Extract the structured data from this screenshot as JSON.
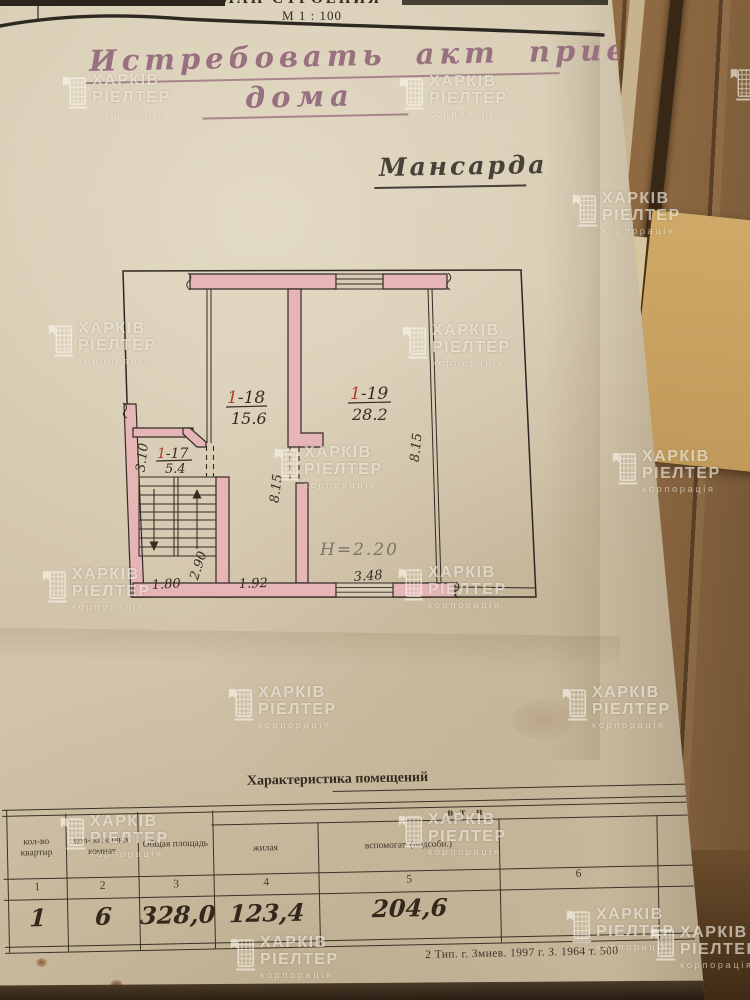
{
  "header": {
    "doc_title_partial": "ПЛАН СТРОЕНИЯ",
    "scale_label": "М 1 : 100"
  },
  "handwriting": {
    "line1": "Истребовать акт приемки",
    "line2": "дома",
    "floor_label": "Мансарда"
  },
  "plan": {
    "rooms": {
      "r17": {
        "red": "1",
        "rest": "-17",
        "area": "5.4"
      },
      "r18": {
        "red": "1",
        "rest": "-18",
        "area": "15.6"
      },
      "r19": {
        "red": "1",
        "rest": "-19",
        "area": "28.2"
      }
    },
    "height_note": "Н=2.20",
    "dims": {
      "left_height": "3.10",
      "stair_width": "1.80",
      "stair_depth": "2.90",
      "corridor_width": "1.92",
      "window_width": "3.48",
      "depth_left": "8.15",
      "depth_right": "8.15"
    },
    "colors": {
      "wall_fill": "#e6b6b6",
      "ink": "#332b24",
      "room_number_red": "#b23b2e"
    }
  },
  "table": {
    "title": "Характеристика помещений",
    "including_label": "в т. ч.",
    "columns": [
      {
        "num": "1",
        "header": "кол-во квартир",
        "value": "1"
      },
      {
        "num": "2",
        "header": "кол-во жилых комнат",
        "value": "6"
      },
      {
        "num": "3",
        "header": "Общая площадь",
        "value": "328,0"
      },
      {
        "num": "4",
        "header": "жилая",
        "value": "123,4"
      },
      {
        "num": "5",
        "header": "вспомогат. (подсобн.)",
        "value": "204,6"
      },
      {
        "num": "6",
        "header": "",
        "value": ""
      }
    ]
  },
  "imprint": "2 Тип. г. Змиев. 1997 г. З. 1964 т. 500",
  "watermark": {
    "line1": "ХАРКІВ",
    "line2": "РІЕЛТЕР",
    "line3": "корпорація",
    "positions": [
      [
        60,
        72
      ],
      [
        397,
        73
      ],
      [
        728,
        64
      ],
      [
        570,
        190
      ],
      [
        46,
        320
      ],
      [
        400,
        322
      ],
      [
        272,
        444
      ],
      [
        610,
        448
      ],
      [
        40,
        566
      ],
      [
        396,
        564
      ],
      [
        226,
        684
      ],
      [
        560,
        684
      ],
      [
        58,
        813
      ],
      [
        396,
        811
      ],
      [
        564,
        906
      ],
      [
        228,
        934
      ],
      [
        648,
        924
      ]
    ]
  }
}
